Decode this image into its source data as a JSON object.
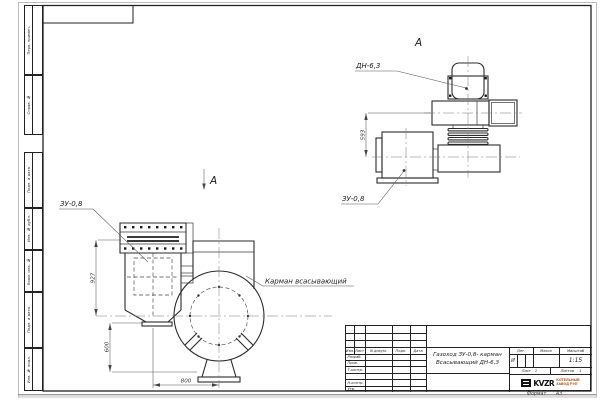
{
  "sheet": {
    "format_label": "Формат",
    "format_value": "А3",
    "sidebar": {
      "items": [
        {
          "label": "Перв. примен."
        },
        {
          "label": "Справ. №"
        },
        {
          "label": "Подп. и дата"
        },
        {
          "label": "Инв. № дубл."
        },
        {
          "label": "Взам. инв. №"
        },
        {
          "label": "Подп. и дата"
        },
        {
          "label": "Инв. № подл."
        }
      ]
    },
    "views": {
      "main": {
        "marker_letter": "А",
        "zu_label": "ЗУ-0,8",
        "pocket_label": "Карман всасывающий",
        "dim_height_upper": "927",
        "dim_height_lower": "600",
        "dim_width": "800"
      },
      "aux": {
        "view_letter": "А",
        "dn_label": "ДН-6,3",
        "zu_label": "ЗУ-0,8",
        "dim_height": "593"
      }
    },
    "title_block": {
      "rev_headers": [
        "Изм.",
        "Лист",
        "N докум.",
        "Подп.",
        "Дата"
      ],
      "sign_rows": [
        "Разраб.",
        "Пров.",
        "Т.контр.",
        "",
        "Н.контр.",
        "Утв."
      ],
      "doc_title_line1": "Газоход ЗУ-0,8- карман",
      "doc_title_line2": "Всасывающий ДН-6,3",
      "lit_label": "Лит.",
      "lit_value": "И",
      "mass_label": "Масса",
      "scale_label": "Масштаб",
      "scale_value": "1:15",
      "sheet_label": "Лист",
      "sheet_value": "1",
      "sheets_label": "Листов",
      "sheets_value": "1",
      "company_logo": "KVZR",
      "company_line1": "КОТЕЛЬНЫЙ",
      "company_line2": "ЗАВОД РЭП"
    }
  }
}
